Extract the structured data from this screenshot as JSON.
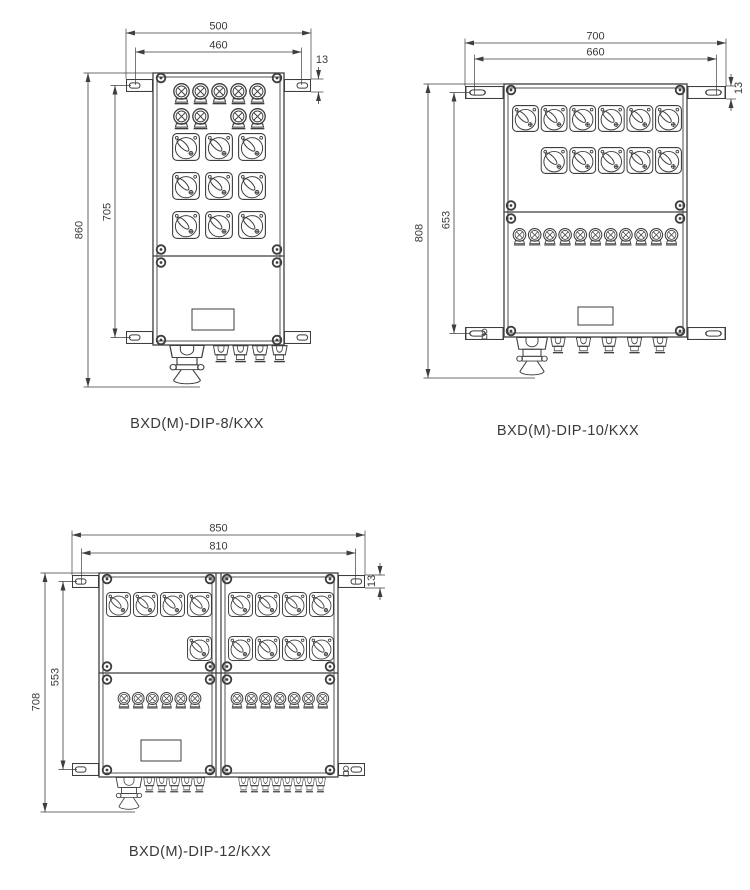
{
  "page": {
    "background": "#ffffff",
    "line_color": "#3e3e3e",
    "label_color": "#3a3a3a"
  },
  "diagrams": [
    {
      "title": "BXD(M)-DIP-8/KXX",
      "dims": {
        "width_outer": "500",
        "width_inner": "460",
        "bracket_offset": "13",
        "height_outer": "860",
        "height_inner": "705"
      },
      "features": {
        "indicator_lights": 9,
        "rotary_switches": 9,
        "cable_glands_small": 4,
        "cable_glands_large": 1,
        "mounting_brackets": 4
      }
    },
    {
      "title": "BXD(M)-DIP-10/KXX",
      "dims": {
        "width_outer": "700",
        "width_inner": "660",
        "bracket_offset": "13",
        "height_outer": "808",
        "height_inner": "653"
      },
      "features": {
        "indicator_lights": 11,
        "rotary_switches": 11,
        "cable_glands_small": 5,
        "cable_glands_large": 1,
        "mounting_brackets": 4
      }
    },
    {
      "title": "BXD(M)-DIP-12/KXX",
      "dims": {
        "width_outer": "850",
        "width_inner": "810",
        "bracket_offset": "13",
        "height_outer": "708",
        "height_inner": "553"
      },
      "features": {
        "indicator_lights": 13,
        "rotary_switches": 13,
        "cable_glands_small": 13,
        "cable_glands_large": 1,
        "mounting_brackets": 4
      }
    }
  ]
}
